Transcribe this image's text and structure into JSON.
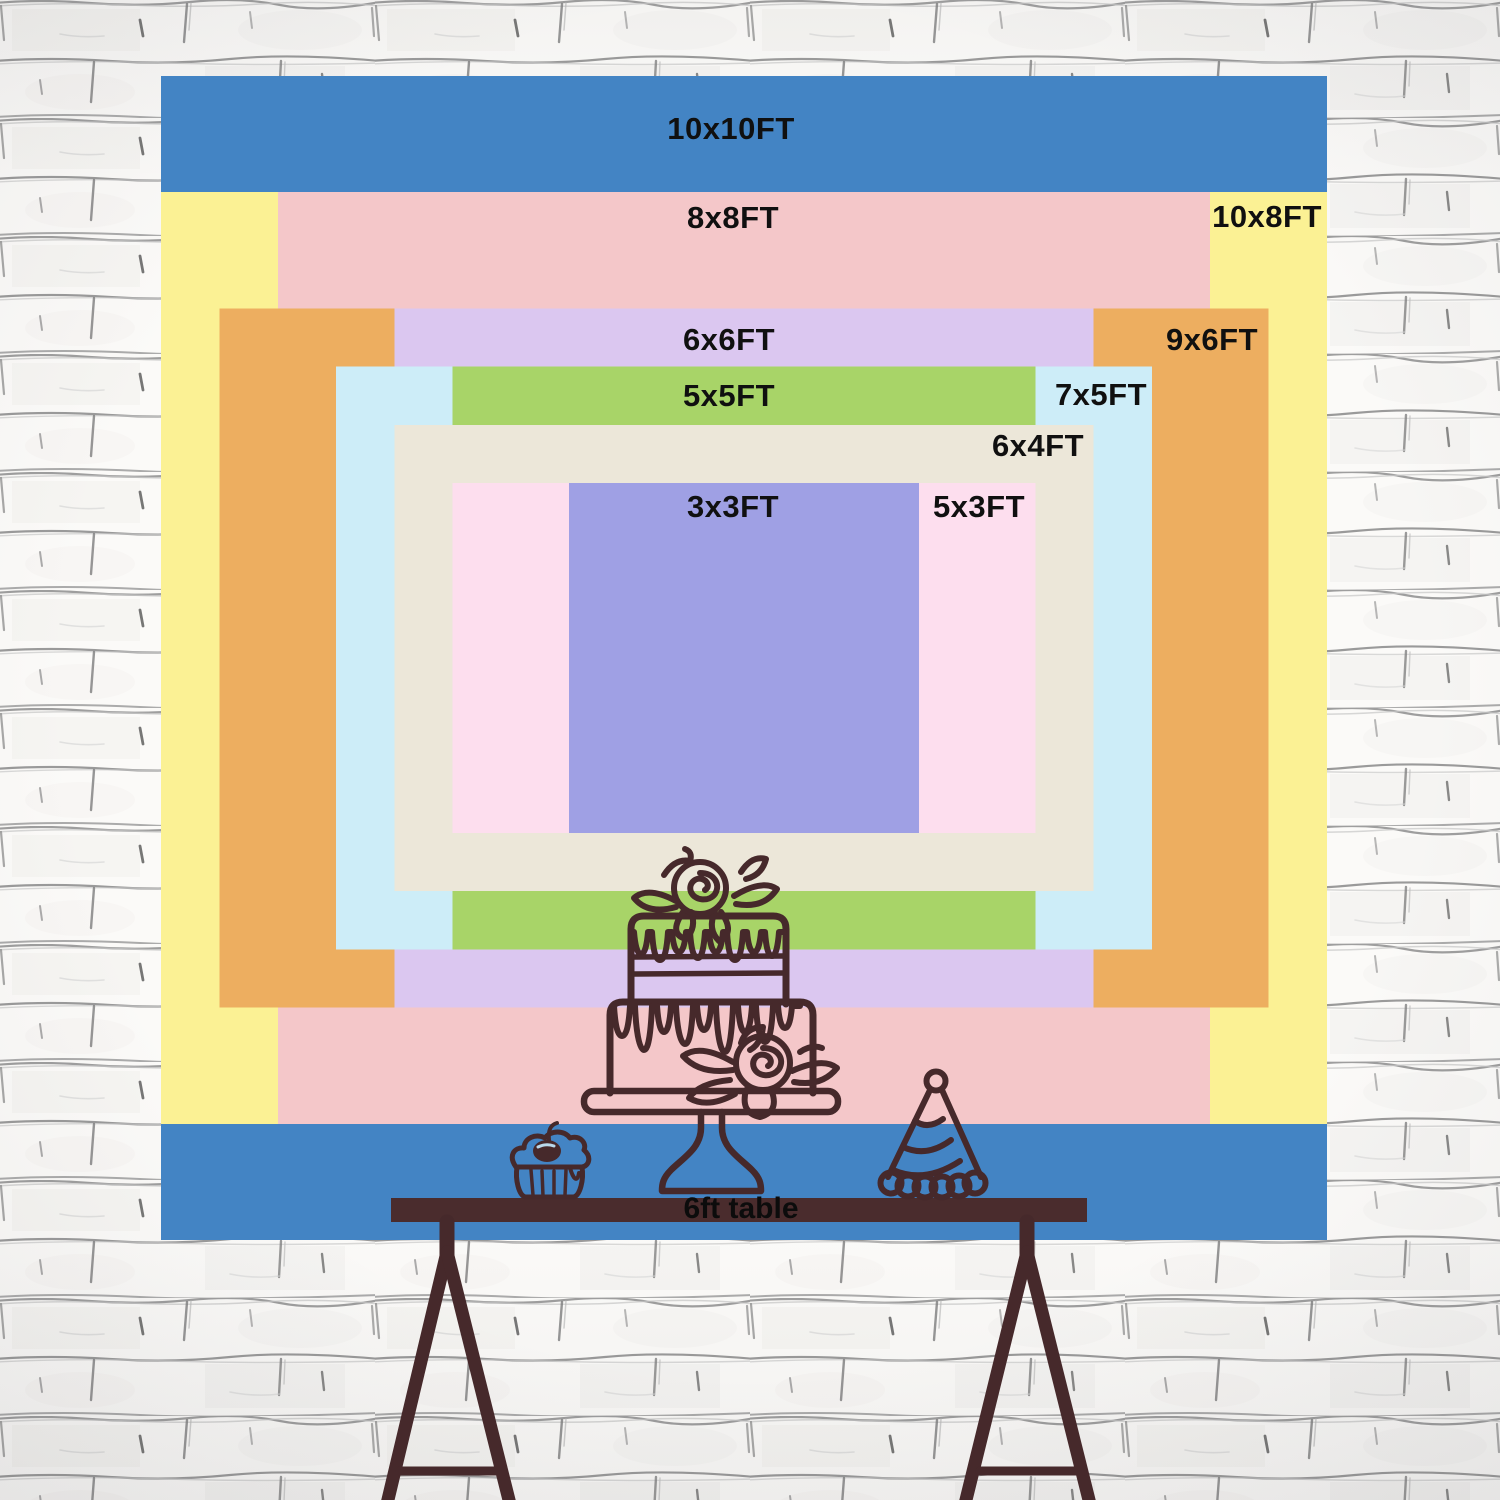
{
  "chart_title": "Backdrop size comparison chart",
  "layers": [
    {
      "id": "10x10",
      "label": "10x10FT",
      "width_ft": 10,
      "height_ft": 10,
      "color": "#4384C4"
    },
    {
      "id": "10x8",
      "label": "10x8FT",
      "width_ft": 10,
      "height_ft": 8,
      "color": "#FBF194"
    },
    {
      "id": "8x8",
      "label": "8x8FT",
      "width_ft": 8,
      "height_ft": 8,
      "color": "#F4C7C9"
    },
    {
      "id": "9x6",
      "label": "9x6FT",
      "width_ft": 9,
      "height_ft": 6,
      "color": "#EDAE60"
    },
    {
      "id": "6x6",
      "label": "6x6FT",
      "width_ft": 6,
      "height_ft": 6,
      "color": "#DBC7F0"
    },
    {
      "id": "7x5",
      "label": "7x5FT",
      "width_ft": 7,
      "height_ft": 5,
      "color": "#CDEDF8"
    },
    {
      "id": "5x5",
      "label": "5x5FT",
      "width_ft": 5,
      "height_ft": 5,
      "color": "#A8D468"
    },
    {
      "id": "6x4",
      "label": "6x4FT",
      "width_ft": 6,
      "height_ft": 4,
      "color": "#ECE7D9"
    },
    {
      "id": "5x3",
      "label": "5x3FT",
      "width_ft": 5,
      "height_ft": 3,
      "color": "#FDDEEE"
    },
    {
      "id": "3x3",
      "label": "3x3FT",
      "width_ft": 3,
      "height_ft": 3,
      "color": "#9FA0E4"
    }
  ],
  "table": {
    "label": "6ft table",
    "color": "#4A2C2D"
  },
  "illustrations": {
    "outline_color": "#46292B",
    "items": [
      "two-tier-cake",
      "cupcake-with-cherry",
      "party-hat"
    ]
  },
  "wall": {
    "style": "hand-drawn white brick",
    "base_color": "#FBFAF8",
    "line_color": "#8E8E8E"
  }
}
